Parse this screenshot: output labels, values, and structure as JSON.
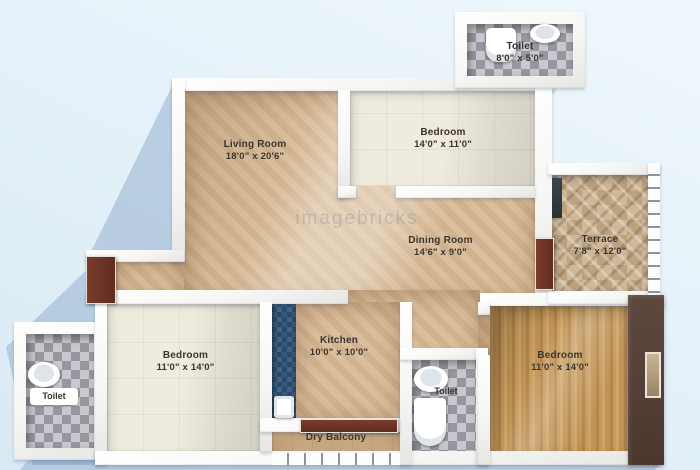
{
  "plan": {
    "watermark": "imagebricks",
    "rooms": {
      "toilet_top": {
        "label": "Toilet",
        "size": "8'0\" x 5'0\""
      },
      "living_room": {
        "label": "Living Room",
        "size": "18'0\" x 20'6\""
      },
      "bedroom_top": {
        "label": "Bedroom",
        "size": "14'0\" x 11'0\""
      },
      "dining_room": {
        "label": "Dining Room",
        "size": "14'6\" x 9'0\""
      },
      "terrace": {
        "label": "Terrace",
        "size": "7'8\" x 12'0\""
      },
      "bedroom_left": {
        "label": "Bedroom",
        "size": "11'0\" x 14'0\""
      },
      "kitchen": {
        "label": "Kitchen",
        "size": "10'0\" x 10'0\""
      },
      "toilet_left": {
        "label": "Toilet"
      },
      "toilet_mid": {
        "label": "Toilet"
      },
      "dry_balcony": {
        "label": "Dry Balcony"
      },
      "bedroom_right": {
        "label": "Bedroom",
        "size": "11'0\" x 14'0\""
      }
    },
    "colors": {
      "background": "#e3f0f8",
      "wall": "#fafafa",
      "floor_beige": "#d8b994",
      "floor_pale": "#ece7da",
      "wood": "#c0945a",
      "dark_wall": "#52403a",
      "tile_dark": "#96969e",
      "tile_light": "#c8c8ce",
      "kitchen_counter": "#2f4d6b",
      "door": "#6e3427",
      "shadow": "#7a9cc4"
    }
  }
}
